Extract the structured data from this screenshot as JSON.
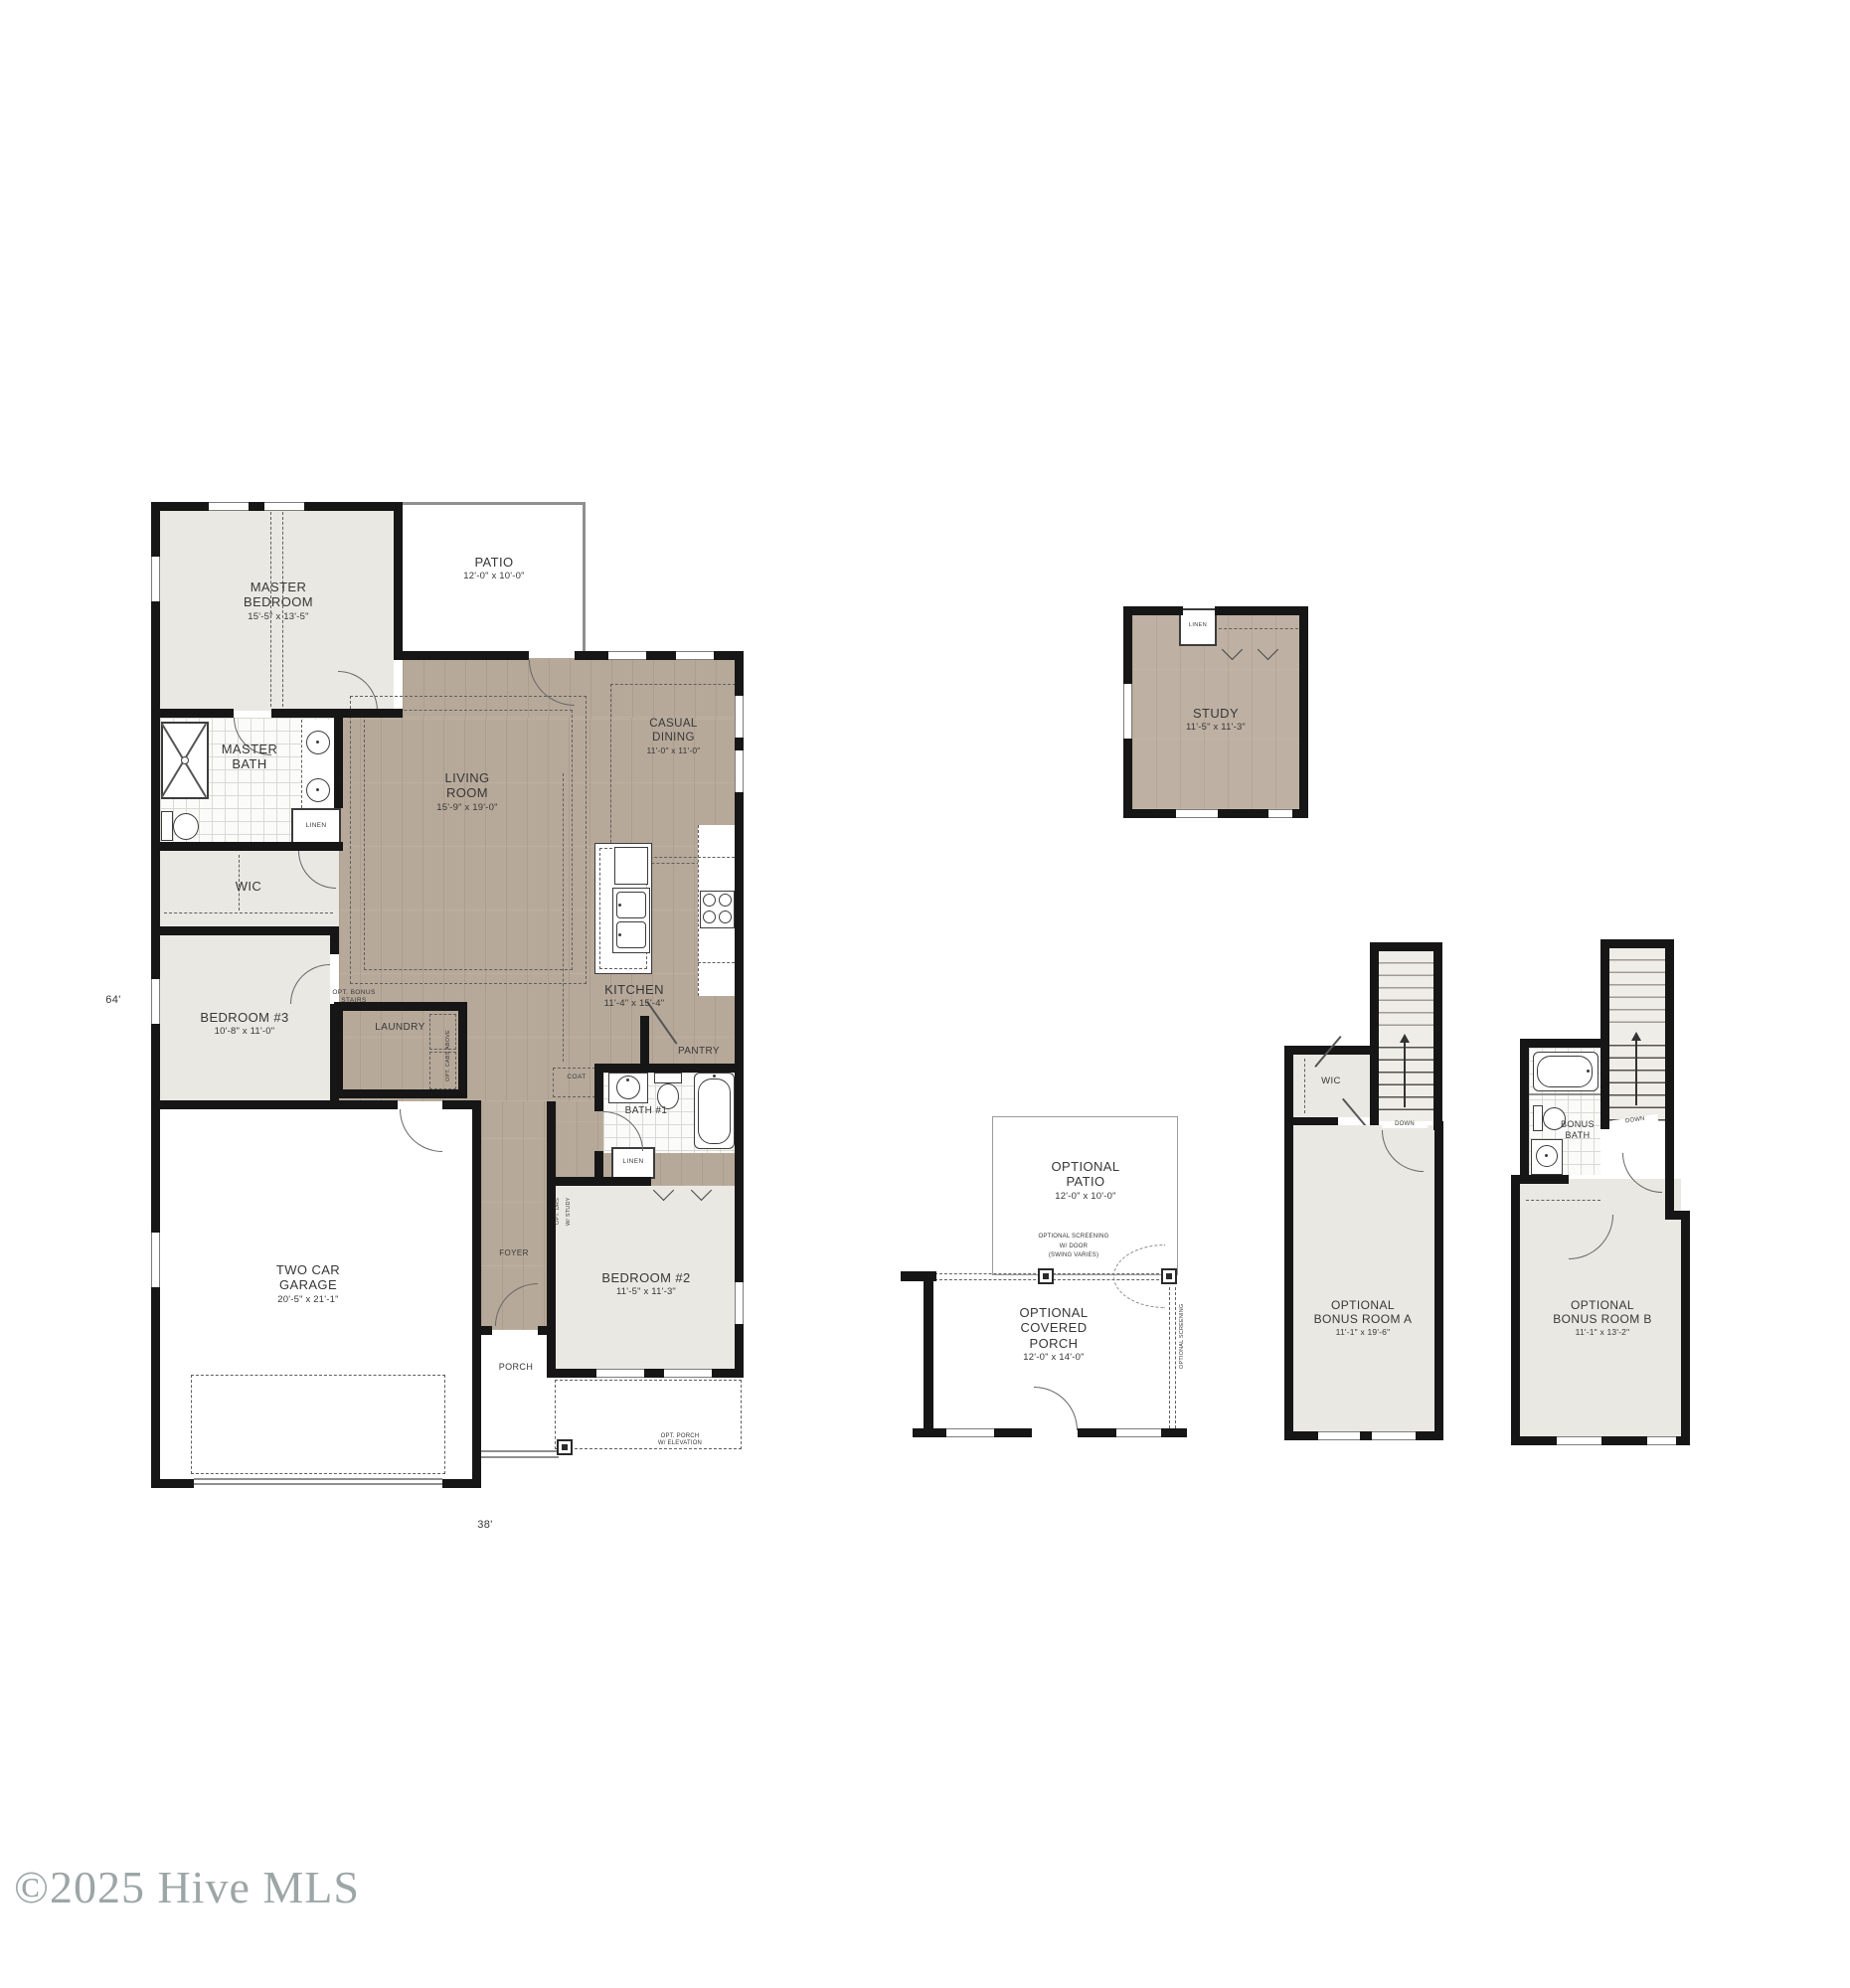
{
  "watermark": "©2025 Hive MLS",
  "plan_dimensions": {
    "depth": "64'",
    "width": "38'"
  },
  "first_floor": {
    "master_bedroom": {
      "line1": "MASTER",
      "line2": "BEDROOM",
      "dims": "15'-5\" x 13'-5\""
    },
    "patio": {
      "line1": "PATIO",
      "dims": "12'-0\" x 10'-0\""
    },
    "master_bath": {
      "line1": "MASTER",
      "line2": "BATH"
    },
    "linen_master": "LINEN",
    "wic": "WIC",
    "bedroom3": {
      "line1": "BEDROOM #3",
      "dims": "10'-8\" x 11'-0\""
    },
    "living_room": {
      "line1": "LIVING",
      "line2": "ROOM",
      "dims": "15'-9\" x 19'-0\""
    },
    "casual_dining": {
      "line1": "CASUAL",
      "line2": "DINING",
      "dims": "11'-0\" x 11'-0\""
    },
    "kitchen": {
      "line1": "KITCHEN",
      "dims": "11'-4\" x 15'-4\""
    },
    "pantry": "PANTRY",
    "laundry": "LAUNDRY",
    "opt_bonus_stairs": {
      "line1": "OPT. BONUS",
      "line2": "STAIRS"
    },
    "opt_cabs_above": "OPT. CABS ABOVE",
    "coat": "COAT",
    "bath1": "BATH #1",
    "linen_hall": "LINEN",
    "bedroom2": {
      "line1": "BEDROOM #2",
      "dims": "11'-5\" x 11'-3\"",
      "note_line1": "OPT. DRS",
      "note_line2": "W/ STUDY"
    },
    "foyer": "FOYER",
    "porch": "PORCH",
    "opt_porch": {
      "line1": "OPT. PORCH",
      "line2": "W/ ELEVATION"
    },
    "garage": {
      "line1": "TWO CAR",
      "line2": "GARAGE",
      "dims": "20'-5\" x 21'-1\""
    }
  },
  "study_option": {
    "room": {
      "line1": "STUDY",
      "dims": "11'-5\" x 11'-3\""
    },
    "linen": "LINEN"
  },
  "porch_option": {
    "patio": {
      "line1": "OPTIONAL",
      "line2": "PATIO",
      "dims": "12'-0\" x 10'-0\""
    },
    "screening_note": {
      "line1": "OPTIONAL SCREENING",
      "line2": "W/ DOOR",
      "line3": "(SWING VARIES)"
    },
    "covered_porch": {
      "line1": "OPTIONAL",
      "line2": "COVERED",
      "line3": "PORCH",
      "dims": "12'-0\" x 14'-0\""
    },
    "screening_side": "OPTIONAL SCREENING"
  },
  "bonus_room_a": {
    "wic": "WIC",
    "down": "DOWN",
    "room": {
      "line1": "OPTIONAL",
      "line2": "BONUS ROOM A",
      "dims": "11'-1\" x 19'-6\""
    }
  },
  "bonus_room_b": {
    "bath": {
      "line1": "BONUS",
      "line2": "BATH"
    },
    "down": "DOWN",
    "room": {
      "line1": "OPTIONAL",
      "line2": "BONUS ROOM B",
      "dims": "11'-1\" x 13'-2\""
    }
  },
  "colors": {
    "wood_floor": "#b7a99a",
    "carpet": "#eae8e3",
    "wall": "#161616",
    "watermark": "#8c9797"
  }
}
